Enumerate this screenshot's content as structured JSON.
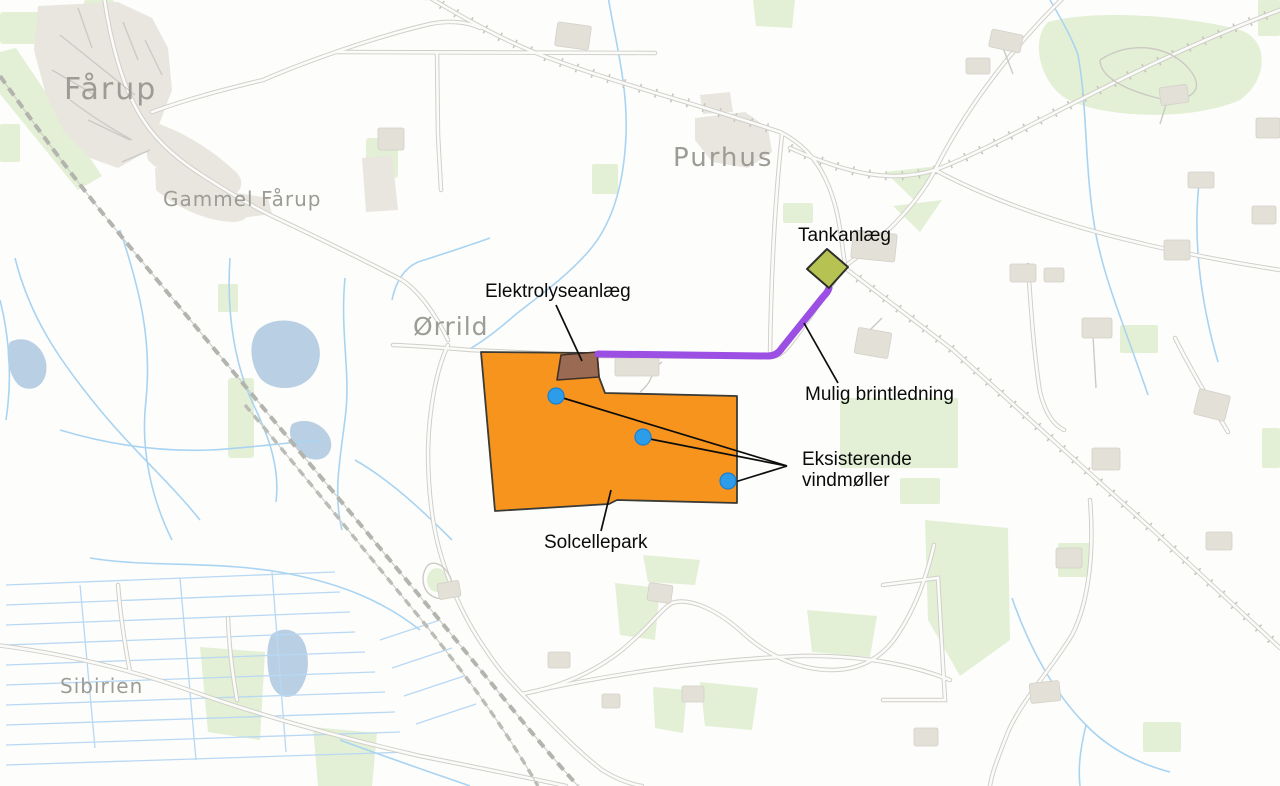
{
  "map": {
    "background_color": "#fdfdfc",
    "places": {
      "faarup": "Fårup",
      "gammel_faarup": "Gammel Fårup",
      "purhus": "Purhus",
      "oerrild": "Ørrild",
      "sibirien": "Sibirien"
    },
    "place_label_color": "#9c9c95",
    "road_color": "#d0cec8",
    "stream_color": "#a9d4f1",
    "pond_color": "#b9cfe4",
    "green_area_color": "#e3f0d5",
    "building_color": "#e3e1d7"
  },
  "annotations": {
    "tank_facility": {
      "label": "Tankanlæg",
      "color": "#b6c353"
    },
    "electrolysis_plant": {
      "label": "Elektrolyseanlæg",
      "color": "#9a6a52"
    },
    "hydrogen_pipeline": {
      "label": "Mulig brintledning",
      "color": "#9b4fe3"
    },
    "wind_turbines": {
      "label_line1": "Eksisterende",
      "label_line2": "vindmøller",
      "color": "#2d9de9",
      "count": 3
    },
    "solar_park": {
      "label": "Solcellepark",
      "color": "#f7941e"
    },
    "leader_line_color": "#0d0d0d"
  }
}
